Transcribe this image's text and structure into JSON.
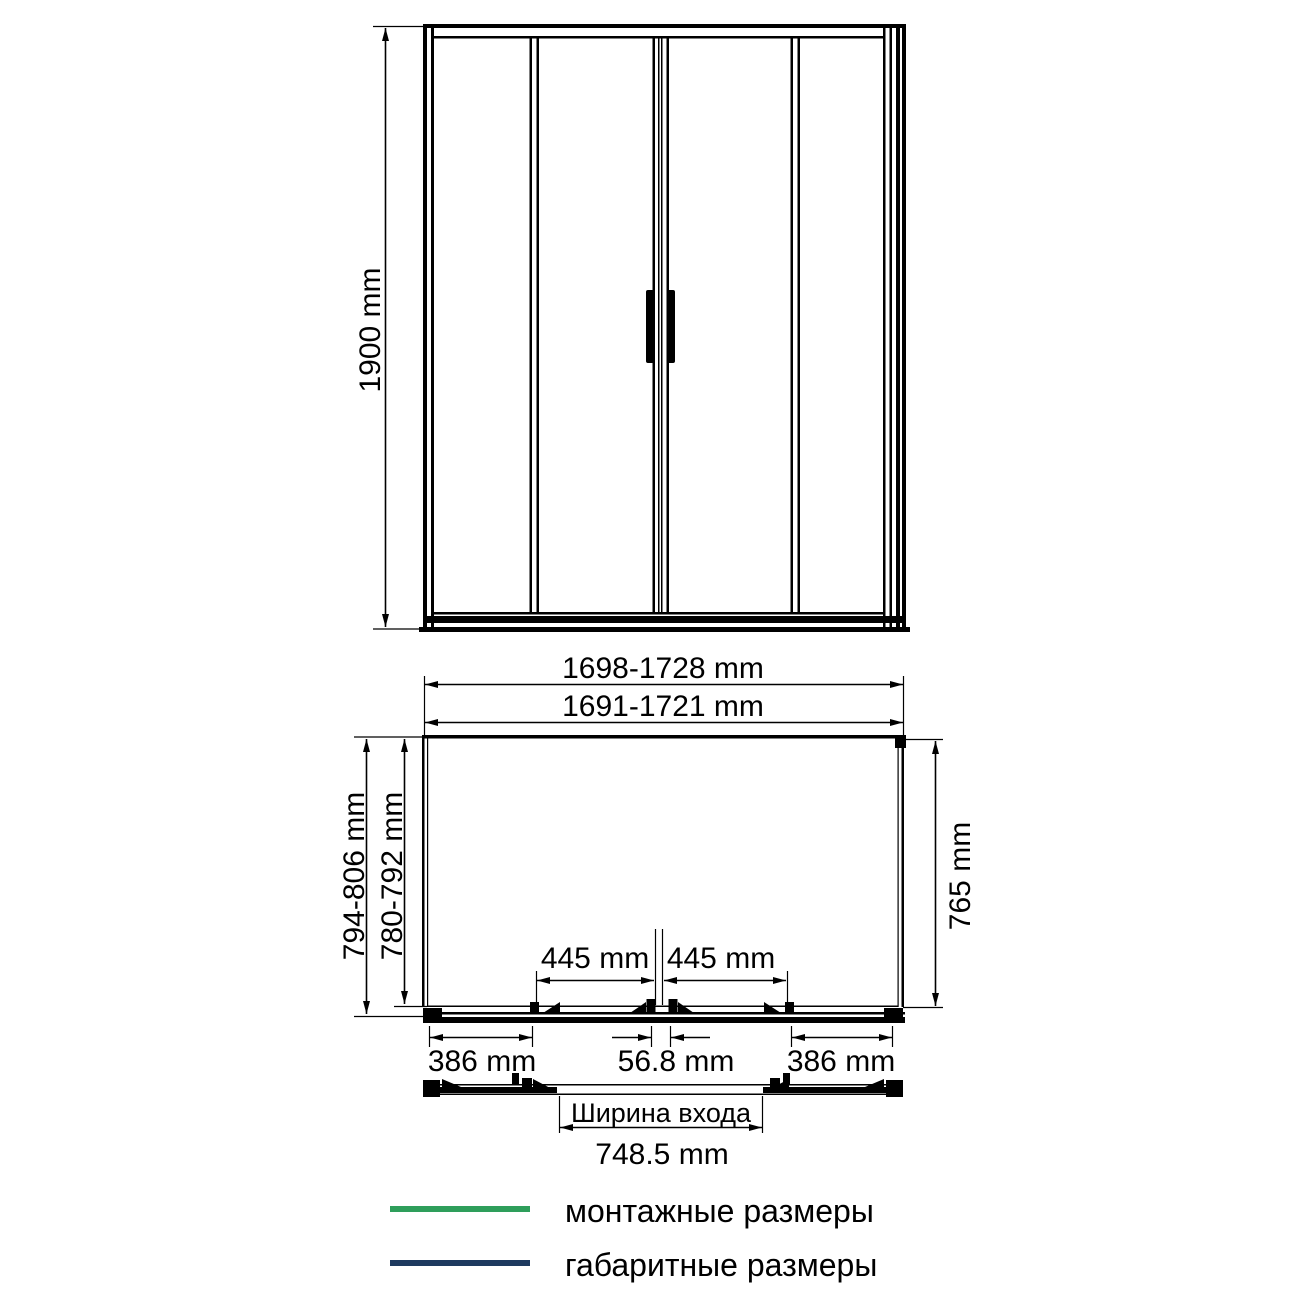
{
  "colors": {
    "mounting_green": "#2E9E5B",
    "overall_navy": "#1E3A5F",
    "drawing_black": "#000000"
  },
  "front_view": {
    "height_label": "1900 mm"
  },
  "plan_view": {
    "overall_width_label": "1698-1728 mm",
    "mounting_width_label": "1691-1721 mm",
    "overall_depth_label": "794-806 mm",
    "mounting_depth_label": "780-792 mm",
    "inner_depth_label": "765 mm",
    "left_door_width_label": "445 mm",
    "right_door_width_label": "445 mm",
    "left_side_panel_label": "386 mm",
    "center_overlap_label": "56.8 mm",
    "right_side_panel_label": "386 mm"
  },
  "entrance_view": {
    "caption": "Ширина входа",
    "width_label": "748.5 mm"
  },
  "legend": {
    "items": [
      {
        "label": "монтажные размеры",
        "color": "#2E9E5B"
      },
      {
        "label": "габаритные размеры",
        "color": "#1E3A5F"
      }
    ]
  }
}
